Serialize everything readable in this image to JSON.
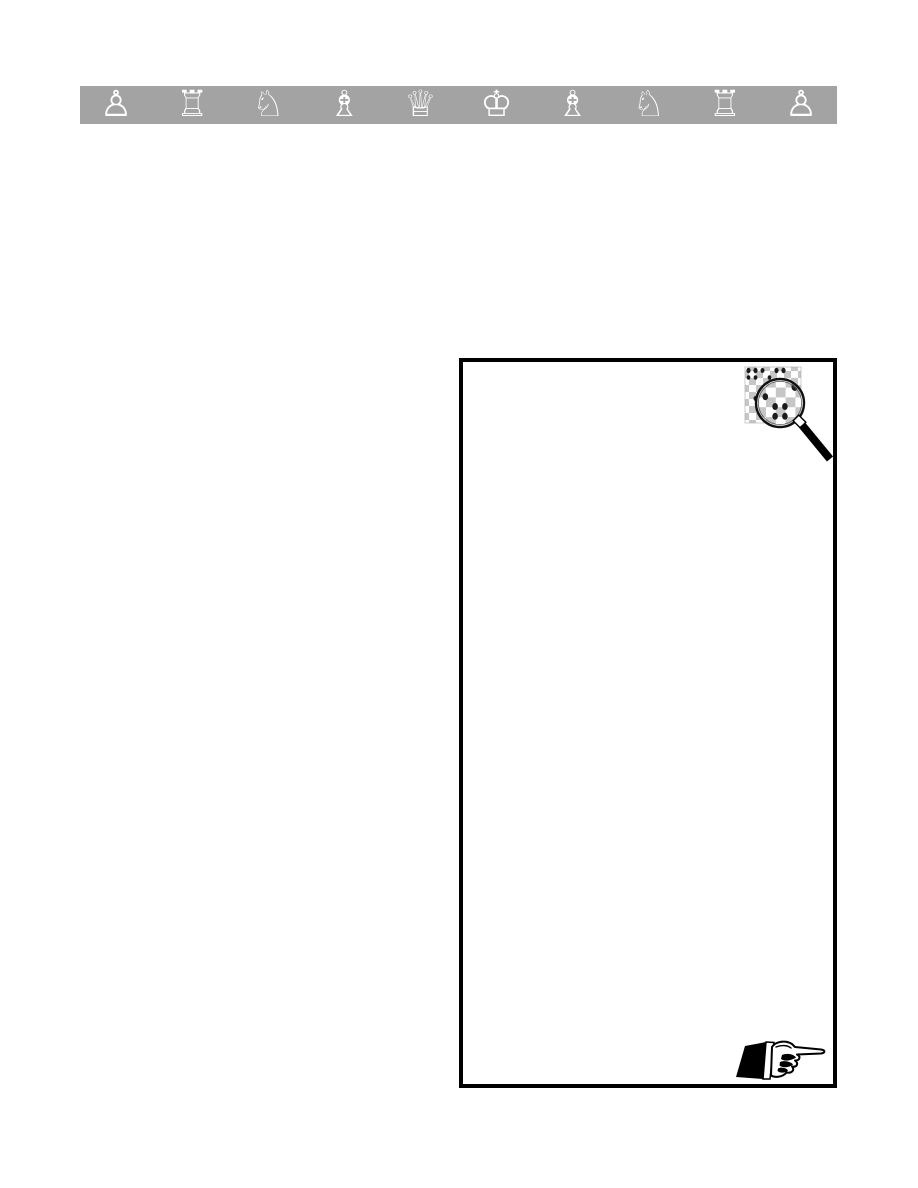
{
  "page": {
    "background_color": "#ffffff"
  },
  "banner": {
    "background_color": "#a3a3a3",
    "piece_color": "#ffffff",
    "pieces": [
      {
        "name": "white-pawn",
        "glyph": "♙"
      },
      {
        "name": "white-rook",
        "glyph": "♖"
      },
      {
        "name": "white-knight",
        "glyph": "♘"
      },
      {
        "name": "white-bishop",
        "glyph": "♗"
      },
      {
        "name": "white-queen",
        "glyph": "♕"
      },
      {
        "name": "white-king",
        "glyph": "♔"
      },
      {
        "name": "white-bishop",
        "glyph": "♗"
      },
      {
        "name": "white-knight",
        "glyph": "♘"
      },
      {
        "name": "white-rook",
        "glyph": "♖"
      },
      {
        "name": "white-pawn",
        "glyph": "♙"
      }
    ]
  },
  "content_box": {
    "border_color": "#000000",
    "background_color": "#ffffff"
  },
  "illustrations": {
    "magnifier": {
      "icon": "magnifying-glass-over-chessboard",
      "board_light_color": "#ffffff",
      "board_dark_color": "#c6c6c6",
      "lens_ring_color": "#111111",
      "handle_color": "#000000",
      "piece_mark_color": "#1c1c1c"
    },
    "manicule": {
      "icon": "right-pointing-hand",
      "hand_color": "#ffffff",
      "outline_color": "#000000",
      "sleeve_color": "#000000"
    }
  }
}
